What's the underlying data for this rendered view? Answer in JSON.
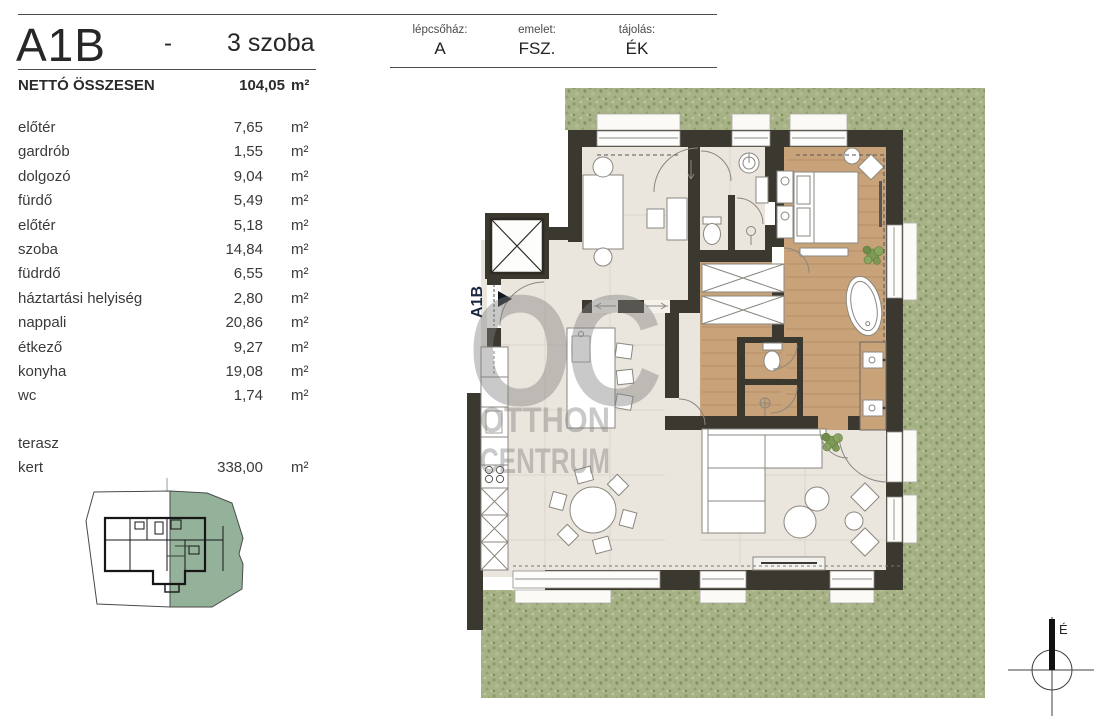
{
  "header": {
    "unit_code": "A1B",
    "separator": "-",
    "room_count": "3 szoba",
    "fields": [
      {
        "label": "lépcsőház:",
        "value": "A"
      },
      {
        "label": "emelet:",
        "value": "FSZ."
      },
      {
        "label": "tájolás:",
        "value": "ÉK"
      }
    ]
  },
  "summary": {
    "label": "NETTÓ ÖSSZESEN",
    "value": "104,05",
    "unit": "m²"
  },
  "table": {
    "rows": [
      {
        "label": "előtér",
        "value": "7,65",
        "unit": "m²"
      },
      {
        "label": "gardrób",
        "value": "1,55",
        "unit": "m²"
      },
      {
        "label": "dolgozó",
        "value": "9,04",
        "unit": "m²"
      },
      {
        "label": "fürdő",
        "value": "5,49",
        "unit": "m²"
      },
      {
        "label": "előtér",
        "value": "5,18",
        "unit": "m²"
      },
      {
        "label": "szoba",
        "value": "14,84",
        "unit": "m²"
      },
      {
        "label": "füdrdő",
        "value": "6,55",
        "unit": "m²"
      },
      {
        "label": "háztartási helyiség",
        "value": "2,80",
        "unit": "m²"
      },
      {
        "label": "nappali",
        "value": "20,86",
        "unit": "m²"
      },
      {
        "label": "étkező",
        "value": "9,27",
        "unit": "m²"
      },
      {
        "label": "konyha",
        "value": "19,08",
        "unit": "m²"
      },
      {
        "label": "wc",
        "value": "1,74",
        "unit": "m²"
      },
      {
        "label": "terasz",
        "value": "",
        "unit": "",
        "spacer_before": true
      },
      {
        "label": "kert",
        "value": "338,00",
        "unit": "m²"
      }
    ]
  },
  "plan": {
    "unit_label": "A1B"
  },
  "watermark": {
    "logo": "OC",
    "line1": "OTTHON",
    "line2": "CENTRUM"
  },
  "compass": {
    "north_label": "É"
  },
  "colors": {
    "grass": "#a7b287",
    "wall": "#3b382f",
    "floor": "#eae6de",
    "wood": "#c8a279",
    "minimap_green": "#94b29a",
    "watermark_gray": "#808080",
    "unit_label_navy": "#1b2940"
  }
}
